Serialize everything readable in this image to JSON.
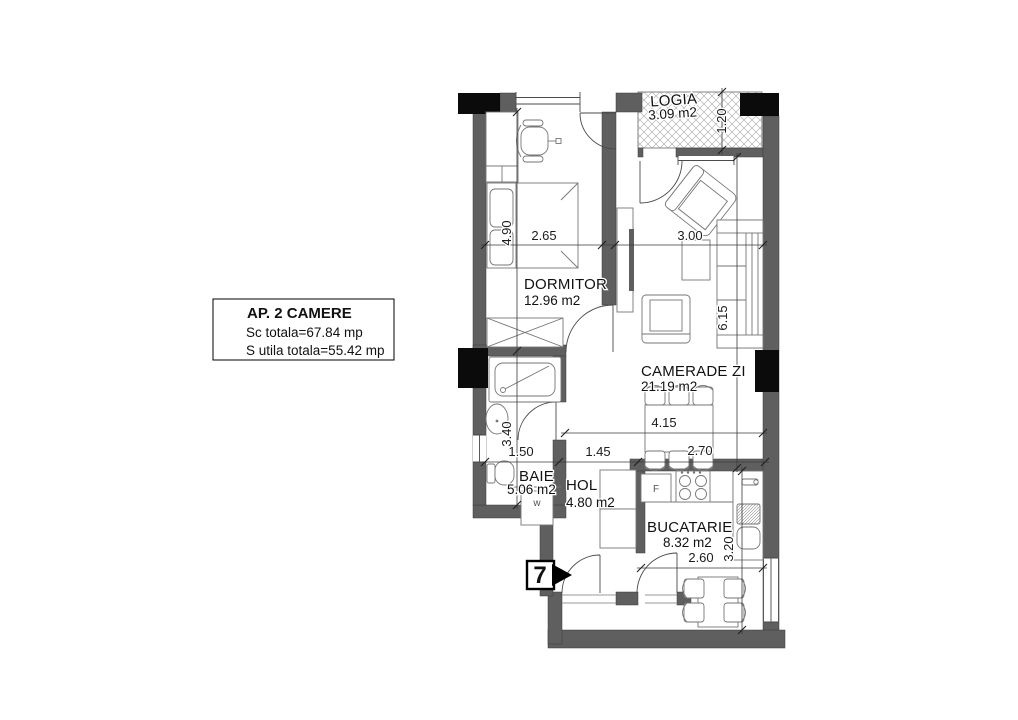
{
  "plan": {
    "title": "AP. 2 CAMERE floor plan",
    "info_box": {
      "title": "AP. 2 CAMERE",
      "built_area": "Sc totala=67.84 mp",
      "usable_area": "S utila totala=55.42 mp"
    },
    "entrance": {
      "number": "7"
    },
    "rooms": {
      "logia": {
        "name": "LOGIA",
        "area": "3.09 m2"
      },
      "dormitor": {
        "name": "DORMITOR",
        "area": "12.96 m2"
      },
      "camera_zi": {
        "name": "CAMERADE ZI",
        "area": "21.19 m2"
      },
      "baie": {
        "name": "BAIE",
        "area": "5.06 m2"
      },
      "hol": {
        "name": "HOL",
        "area": "4.80 m2"
      },
      "bucatarie": {
        "name": "BUCATARIE",
        "area": "8.32 m2"
      }
    },
    "dimensions": {
      "bedroom_width": "2.65",
      "living_width": "3.00",
      "bedroom_depth": "4.90",
      "living_depth": "6.15",
      "logia_depth": "1.20",
      "bath_depth": "3.40",
      "bath_width": "1.50",
      "hall_width": "1.45",
      "dining_width": "2.70",
      "hall_living_span": "4.15",
      "kitchen_width": "2.60",
      "kitchen_depth": "3.20"
    },
    "appliances": {
      "washing_machine": "w",
      "fridge": "F"
    },
    "colors": {
      "wall": "#5f5f5f",
      "column": "#0b0b0b",
      "hatch": "#b5b5b5",
      "dimension_line": "#3a3a3a",
      "furniture_line": "#767676"
    }
  }
}
